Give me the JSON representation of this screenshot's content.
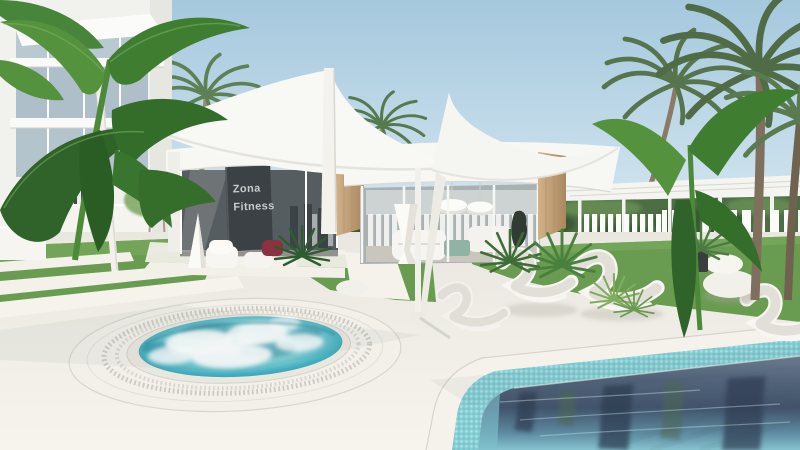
{
  "sign": {
    "line1": "Zona",
    "line2": "Fitness"
  },
  "colors": {
    "sky_top": "#a5c8de",
    "sky_bottom": "#ddecf3",
    "sail": "#f8f8f5",
    "deck": "#efede5",
    "deck_bright": "#f6f4ec",
    "grass": "#699c50",
    "grass_dark": "#4e7c3b",
    "foliage": "#3f7d31",
    "foliage_dark": "#2f6329",
    "foliage_light": "#55923d",
    "palm": "#5d8054",
    "trunk": "#8d7d66",
    "wood": "#c5a57c",
    "glass": "#9aa2a4",
    "glass_dark": "#565d60",
    "sign_bg": "#3c4145",
    "sign_text": "#c7cbcc",
    "fence": "#fbfbf8",
    "hedge": "#4d6d44",
    "pool_deep": "#41536b",
    "pool_shallow": "#86c3cf",
    "tile": "#85ced4",
    "spa_water": "#43aebe",
    "foam": "#ffffff",
    "stone": "#f1f0ea",
    "accent_red": "#8c3140",
    "white": "#f7f7f4"
  },
  "scene": {
    "elements": [
      "apartment-building",
      "sail-canopy-pavilion",
      "fitness-zone-sign",
      "spa-whirlpool",
      "swimming-pool",
      "sun-loungers",
      "palm-trees",
      "banana-plants",
      "pergola",
      "picket-fence",
      "stone-ottomans",
      "cone-sculptures",
      "stepping-stones",
      "pendant-lamps"
    ]
  }
}
